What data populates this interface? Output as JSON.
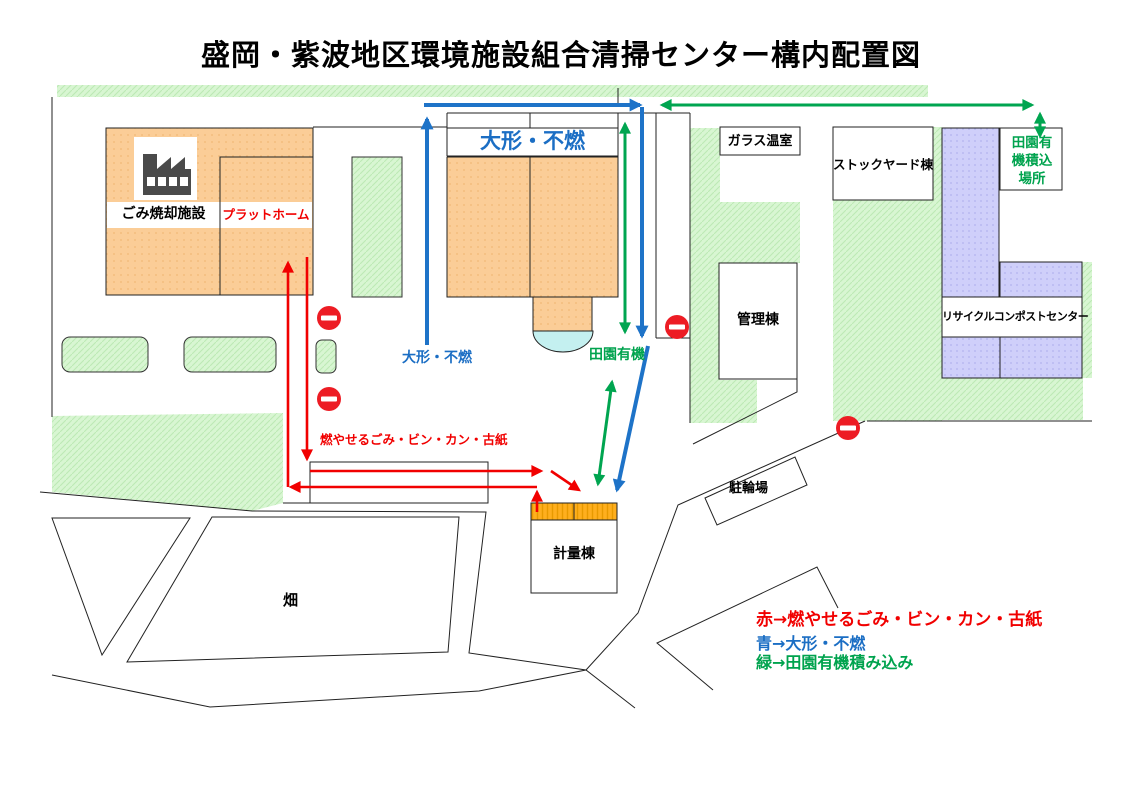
{
  "title": "盛岡・紫波地区環境施設組合清掃センター構内配置図",
  "buildings": {
    "incinerator": "ごみ焼却施設",
    "platform": "プラットホーム",
    "oversized_sign": "大形・不燃",
    "greenhouse": "ガラス温室",
    "stockyard": "ストックヤード棟",
    "denen_loading_place": "田園有機積込場所",
    "admin": "管理棟",
    "recycle_compost": "リサイクルコンポストセンター",
    "weighbridge": "計量棟",
    "bicycle_parking": "駐輪場",
    "field": "畑"
  },
  "route_labels": {
    "burnable_red": "燃やせるごみ・ビン・カン・古紙",
    "oversized_blue": "大形・不燃",
    "denen_green": "田園有機"
  },
  "legend": {
    "red_line": "赤→燃やせるごみ・ビン・カン・古紙",
    "blue_line": "青→大形・不燃",
    "green_line": "緑→田園有機積み込み"
  },
  "icons": {
    "factory": "factory-icon",
    "no_entry": "no-entry-icon"
  },
  "colors": {
    "route_red": "#F10000",
    "route_blue": "#1E73C8",
    "route_green": "#00A550",
    "building_orange": "#FBCD97",
    "weighbridge_orange": "#FFAF1E",
    "area_green": "#D8F6D2",
    "building_purple": "#CFCFFA",
    "dome_cyan": "#C4F0F0",
    "no_entry_red": "#ED1C24"
  }
}
